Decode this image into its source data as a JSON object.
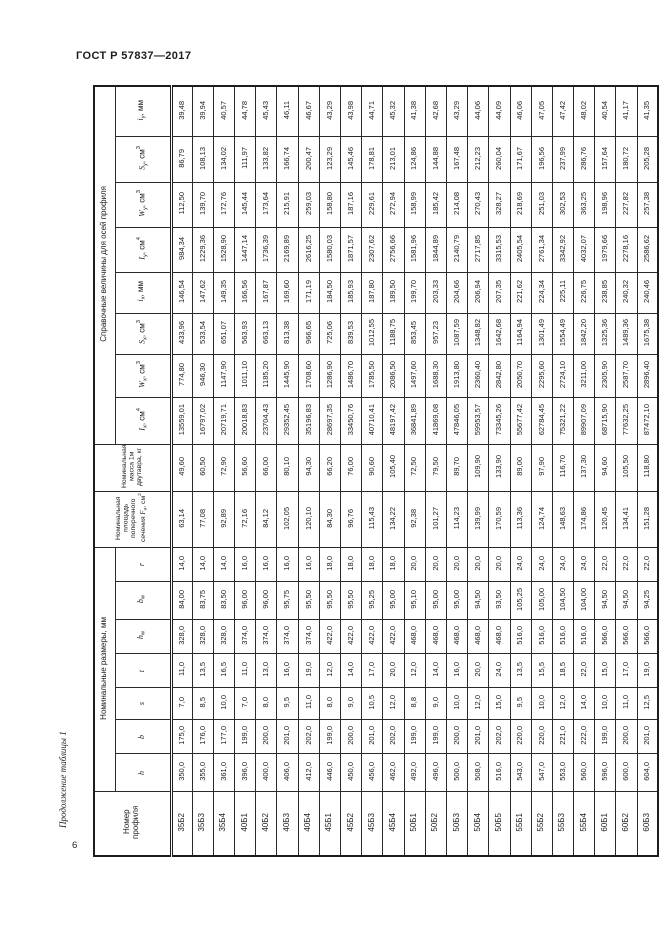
{
  "page": {
    "doc_number": "ГОСТ Р 57837—2017",
    "continuation": "Продолжение таблицы 1",
    "page_number": "6"
  },
  "table": {
    "groups": {
      "reference": "Справочные величины для осей профиля",
      "dimensions": "Номинальные размеры, мм"
    },
    "rows": [
      {
        "name": "iy",
        "group": "reference",
        "header": [
          [
            "i",
            "i"
          ],
          [
            "y",
            "b"
          ],
          [
            ", мм",
            "n"
          ]
        ],
        "values": [
          "39,48",
          "39,94",
          "40,57",
          "44,78",
          "45,43",
          "46,11",
          "46,67",
          "43,29",
          "43,98",
          "44,71",
          "45,32",
          "41,38",
          "42,68",
          "43,29",
          "44,06",
          "44,09",
          "46,06",
          "47,05",
          "47,42",
          "48,02",
          "40,54",
          "41,17",
          "41,35"
        ]
      },
      {
        "name": "Sy",
        "group": "reference",
        "header": [
          [
            "S",
            "i"
          ],
          [
            "y",
            "b"
          ],
          [
            ", см",
            "n"
          ],
          [
            "3",
            "p"
          ]
        ],
        "values": [
          "86,79",
          "108,13",
          "134,02",
          "111,97",
          "133,82",
          "166,74",
          "200,47",
          "123,29",
          "145,46",
          "178,81",
          "213,01",
          "124,86",
          "144,88",
          "167,48",
          "212,23",
          "260,04",
          "171,67",
          "196,56",
          "237,99",
          "286,76",
          "157,64",
          "180,72",
          "205,28"
        ]
      },
      {
        "name": "Wy",
        "group": "reference",
        "header": [
          [
            "W",
            "i"
          ],
          [
            "y",
            "b"
          ],
          [
            ", см",
            "n"
          ],
          [
            "3",
            "p"
          ]
        ],
        "values": [
          "112,50",
          "139,70",
          "172,76",
          "145,44",
          "173,64",
          "215,91",
          "259,03",
          "158,80",
          "187,16",
          "229,61",
          "272,94",
          "158,99",
          "185,42",
          "214,08",
          "270,43",
          "328,27",
          "218,69",
          "251,03",
          "302,53",
          "363,25",
          "198,96",
          "227,82",
          "257,38"
        ]
      },
      {
        "name": "Iy",
        "group": "reference",
        "header": [
          [
            "I",
            "i"
          ],
          [
            "y",
            "b"
          ],
          [
            ", см",
            "n"
          ],
          [
            "4",
            "p"
          ]
        ],
        "values": [
          "984,34",
          "1229,36",
          "1528,90",
          "1447,14",
          "1736,39",
          "2169,89",
          "2616,25",
          "1580,03",
          "1871,57",
          "2307,62",
          "2756,66",
          "1581,96",
          "1844,89",
          "2140,79",
          "2717,85",
          "3315,53",
          "2405,54",
          "2761,34",
          "3342,92",
          "4032,07",
          "1979,66",
          "2278,16",
          "2586,62"
        ]
      },
      {
        "name": "ix",
        "group": "reference",
        "header": [
          [
            "i",
            "i"
          ],
          [
            "x",
            "b"
          ],
          [
            ", мм",
            "n"
          ]
        ],
        "values": [
          "146,54",
          "147,62",
          "149,35",
          "166,56",
          "167,87",
          "169,60",
          "171,19",
          "184,50",
          "185,93",
          "187,80",
          "189,50",
          "199,70",
          "203,33",
          "204,66",
          "206,94",
          "207,35",
          "221,62",
          "224,34",
          "225,11",
          "226,75",
          "238,85",
          "240,32",
          "240,46"
        ]
      },
      {
        "name": "Sx",
        "group": "reference",
        "header": [
          [
            "S",
            "i"
          ],
          [
            "x",
            "b"
          ],
          [
            ", см",
            "n"
          ],
          [
            "3",
            "p"
          ]
        ],
        "values": [
          "433,96",
          "533,54",
          "651,07",
          "563,93",
          "663,13",
          "813,38",
          "966,65",
          "725,06",
          "839,53",
          "1012,55",
          "1188,75",
          "853,45",
          "957,23",
          "1087,59",
          "1348,82",
          "1642,68",
          "1164,94",
          "1301,49",
          "1554,49",
          "1842,20",
          "1325,36",
          "1489,36",
          "1675,38"
        ]
      },
      {
        "name": "Wx",
        "group": "reference",
        "header": [
          [
            "W",
            "i"
          ],
          [
            "x",
            "b"
          ],
          [
            ", см",
            "n"
          ],
          [
            "3",
            "p"
          ]
        ],
        "values": [
          "774,80",
          "946,30",
          "1147,90",
          "1011,10",
          "1185,20",
          "1445,90",
          "1708,60",
          "1286,90",
          "1486,70",
          "1785,50",
          "2086,50",
          "1497,60",
          "1688,30",
          "1913,80",
          "2360,40",
          "2842,80",
          "2050,70",
          "2295,60",
          "2724,10",
          "3211,00",
          "2305,90",
          "2587,70",
          "2896,40"
        ]
      },
      {
        "name": "Ix",
        "group": "reference",
        "header": [
          [
            "I",
            "i"
          ],
          [
            "x",
            "b"
          ],
          [
            ", см",
            "n"
          ],
          [
            "4",
            "p"
          ]
        ],
        "values": [
          "13559,01",
          "16797,02",
          "20719,71",
          "20018,83",
          "23704,43",
          "29352,45",
          "35196,83",
          "28697,35",
          "33450,76",
          "40710,41",
          "48197,42",
          "36841,89",
          "41869,08",
          "47846,05",
          "59953,57",
          "73345,26",
          "55677,42",
          "62784,45",
          "75321,22",
          "89907,09",
          "68715,90",
          "77632,25",
          "87472,10"
        ]
      },
      {
        "name": "mass",
        "group": "full",
        "header": [
          [
            "Номинальная масса 1м двутавра, кг",
            "n"
          ]
        ],
        "values": [
          "49,60",
          "60,50",
          "72,90",
          "56,60",
          "66,00",
          "80,10",
          "94,30",
          "66,20",
          "76,00",
          "90,60",
          "105,40",
          "72,50",
          "79,50",
          "89,70",
          "109,90",
          "133,90",
          "89,00",
          "97,90",
          "116,70",
          "137,30",
          "94,60",
          "105,50",
          "118,80"
        ]
      },
      {
        "name": "area",
        "group": "full",
        "header": [
          [
            "Номинальная площадь поперечного сечения ",
            "n"
          ],
          [
            "F",
            "i"
          ],
          [
            "н",
            "b"
          ],
          [
            ", см",
            "n"
          ],
          [
            "2",
            "p"
          ]
        ],
        "values": [
          "63,14",
          "77,08",
          "92,89",
          "72,16",
          "84,12",
          "102,05",
          "120,10",
          "84,30",
          "96,76",
          "115,43",
          "134,22",
          "92,38",
          "101,27",
          "114,23",
          "139,99",
          "170,59",
          "113,36",
          "124,74",
          "148,63",
          "174,86",
          "120,45",
          "134,41",
          "151,28"
        ]
      },
      {
        "name": "r",
        "group": "dimensions",
        "header": [
          [
            "r",
            "i"
          ]
        ],
        "values": [
          "14,0",
          "14,0",
          "14,0",
          "16,0",
          "16,0",
          "16,0",
          "16,0",
          "18,0",
          "18,0",
          "18,0",
          "18,0",
          "20,0",
          "20,0",
          "20,0",
          "20,0",
          "20,0",
          "24,0",
          "24,0",
          "24,0",
          "24,0",
          "22,0",
          "22,0",
          "22,0"
        ]
      },
      {
        "name": "bw",
        "group": "dimensions",
        "header": [
          [
            "b",
            "i"
          ],
          [
            "w",
            "b"
          ]
        ],
        "values": [
          "84,00",
          "83,75",
          "83,50",
          "96,00",
          "96,00",
          "95,75",
          "95,50",
          "95,50",
          "95,50",
          "95,25",
          "95,00",
          "95,10",
          "95,00",
          "95,00",
          "94,50",
          "93,50",
          "105,25",
          "105,00",
          "104,50",
          "104,00",
          "94,50",
          "94,50",
          "94,25"
        ]
      },
      {
        "name": "hw",
        "group": "dimensions",
        "header": [
          [
            "h",
            "i"
          ],
          [
            "w",
            "b"
          ]
        ],
        "values": [
          "328,0",
          "328,0",
          "328,0",
          "374,0",
          "374,0",
          "374,0",
          "374,0",
          "422,0",
          "422,0",
          "422,0",
          "422,0",
          "468,0",
          "468,0",
          "468,0",
          "468,0",
          "468,0",
          "516,0",
          "516,0",
          "516,0",
          "516,0",
          "566,0",
          "566,0",
          "566,0"
        ]
      },
      {
        "name": "t",
        "group": "dimensions",
        "header": [
          [
            "t",
            "i"
          ]
        ],
        "values": [
          "11,0",
          "13,5",
          "16,5",
          "11,0",
          "13,0",
          "16,0",
          "19,0",
          "12,0",
          "14,0",
          "17,0",
          "20,0",
          "12,0",
          "14,0",
          "16,0",
          "20,0",
          "24,0",
          "13,5",
          "15,5",
          "18,5",
          "22,0",
          "15,0",
          "17,0",
          "19,0"
        ]
      },
      {
        "name": "s",
        "group": "dimensions",
        "header": [
          [
            "s",
            "i"
          ]
        ],
        "values": [
          "7,0",
          "8,5",
          "10,0",
          "7,0",
          "8,0",
          "9,5",
          "11,0",
          "8,0",
          "9,0",
          "10,5",
          "12,0",
          "8,8",
          "9,0",
          "10,0",
          "12,0",
          "15,0",
          "9,5",
          "10,0",
          "12,0",
          "14,0",
          "10,0",
          "11,0",
          "12,5"
        ]
      },
      {
        "name": "b",
        "group": "dimensions",
        "header": [
          [
            "b",
            "i"
          ]
        ],
        "values": [
          "175,0",
          "176,0",
          "177,0",
          "199,0",
          "200,0",
          "201,0",
          "202,0",
          "199,0",
          "200,0",
          "201,0",
          "202,0",
          "199,0",
          "199,0",
          "200,0",
          "201,0",
          "202,0",
          "220,0",
          "220,0",
          "221,0",
          "222,0",
          "199,0",
          "200,0",
          "201,0"
        ]
      },
      {
        "name": "h",
        "group": "dimensions",
        "header": [
          [
            "h",
            "i"
          ]
        ],
        "values": [
          "350,0",
          "355,0",
          "361,0",
          "396,0",
          "400,0",
          "406,0",
          "412,0",
          "446,0",
          "450,0",
          "456,0",
          "462,0",
          "492,0",
          "496,0",
          "500,0",
          "508,0",
          "516,0",
          "543,0",
          "547,0",
          "553,0",
          "560,0",
          "596,0",
          "600,0",
          "604,0"
        ]
      },
      {
        "name": "profile",
        "group": "full",
        "header": [
          [
            "Номер профиля",
            "n"
          ]
        ],
        "values": [
          "35Б2",
          "35Б3",
          "35Б4",
          "40Б1",
          "40Б2",
          "40Б3",
          "40Б4",
          "45Б1",
          "45Б2",
          "45Б3",
          "45Б4",
          "50Б1",
          "50Б2",
          "50Б3",
          "50Б4",
          "50Б5",
          "55Б1",
          "55Б2",
          "55Б3",
          "55Б4",
          "60Б1",
          "60Б2",
          "60Б3"
        ]
      }
    ]
  }
}
